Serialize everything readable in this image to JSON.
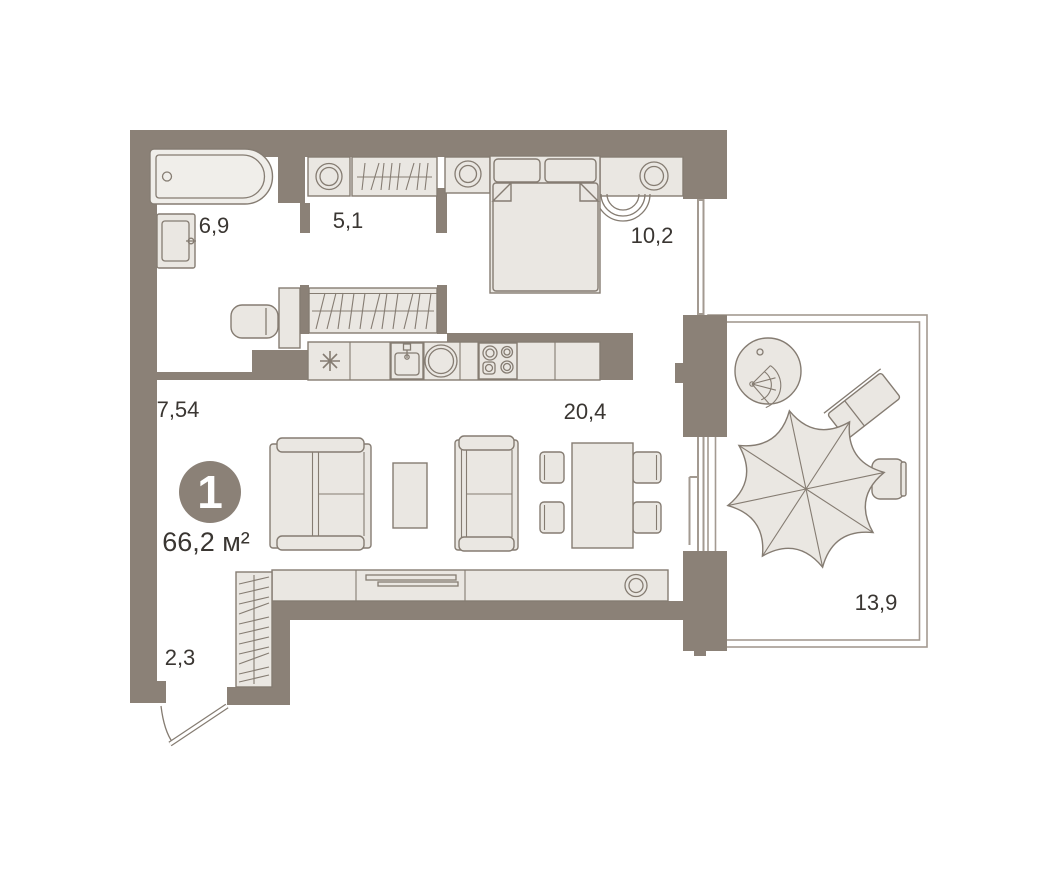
{
  "plan": {
    "badge": {
      "number": "1",
      "area": "66,2 м²"
    },
    "rooms": {
      "bathroom": {
        "area": "6,9"
      },
      "hallway": {
        "area": "5,1"
      },
      "bedroom": {
        "area": "10,2"
      },
      "corridor": {
        "area": "7,54"
      },
      "living": {
        "area": "20,4"
      },
      "entry": {
        "area": "2,3"
      },
      "terrace": {
        "area": "13,9"
      }
    },
    "colors": {
      "wall": "#8b8177",
      "furniture_fill": "#eae7e2",
      "outline": "#857c72",
      "deck_stripe": "#dd8066",
      "terrace_border": "#a39a91",
      "text": "#3a3632",
      "badge_fill": "#8b8177",
      "badge_text": "#ffffff"
    },
    "icons": [
      "bathtub",
      "wash-basin",
      "washing-machine",
      "wardrobe",
      "double-bed",
      "nightstand-lamp",
      "armchair",
      "desk",
      "desk-chair",
      "kitchen-counter",
      "kitchen-sink",
      "stove",
      "fridge-star",
      "sofa",
      "coffee-table",
      "dining-table",
      "dining-chair",
      "tv-sideboard",
      "entry-wardrobe",
      "entry-door",
      "hanging-chair",
      "sun-lounger",
      "parasol",
      "terrace-chair",
      "deck-flooring"
    ]
  }
}
